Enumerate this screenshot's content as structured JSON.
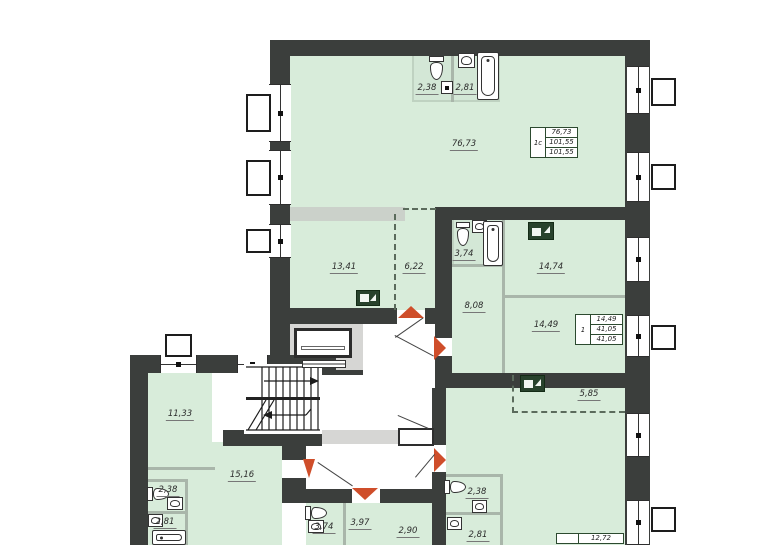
{
  "colors": {
    "room_fill": "#d8ecda",
    "bath_fill": "#d3e7d6",
    "wall": "#3b3e3c",
    "door_arrow_accent": "#cf4e2a",
    "partition_gray": "#cbd1ca",
    "info_border": "#2c4a2f"
  },
  "labels": {
    "apt1c_room": "76,73",
    "apt1c_wc": "2,38",
    "apt1c_bath": "2,81",
    "room_13_41": "13,41",
    "room_6_22": "6,22",
    "apt1_bath": "3,74",
    "room_14_74": "14,74",
    "room_8_08": "8,08",
    "room_14_49": "14,49",
    "kitchen_zone": "5,85",
    "room_11_33": "11,33",
    "room_15_16": "15,16",
    "bl_wc": "2,38",
    "bl_bath": "2,81",
    "bm_bath": "3,74",
    "room_3_97": "3,97",
    "room_2_90": "2,90",
    "br_wc": "2,38",
    "br_bath": "2,81"
  },
  "info_boxes": {
    "apt_1c": {
      "type": "1c",
      "row1": "76,73",
      "row2": "101,55",
      "row3": "101,55"
    },
    "apt_1": {
      "type": "1",
      "row1": "14,49",
      "row2": "41,05",
      "row3": "41,05"
    },
    "apt_bottom": {
      "type": "",
      "row1": "12,72"
    }
  },
  "icons": {
    "kitchen": "kitchen-sink-icon",
    "electrical_panel": "electrical-panel-icon",
    "toilet": "toilet-icon",
    "sink": "sink-icon",
    "bathtub": "bathtub-icon",
    "stairs": "staircase",
    "elevator": "elevator"
  }
}
